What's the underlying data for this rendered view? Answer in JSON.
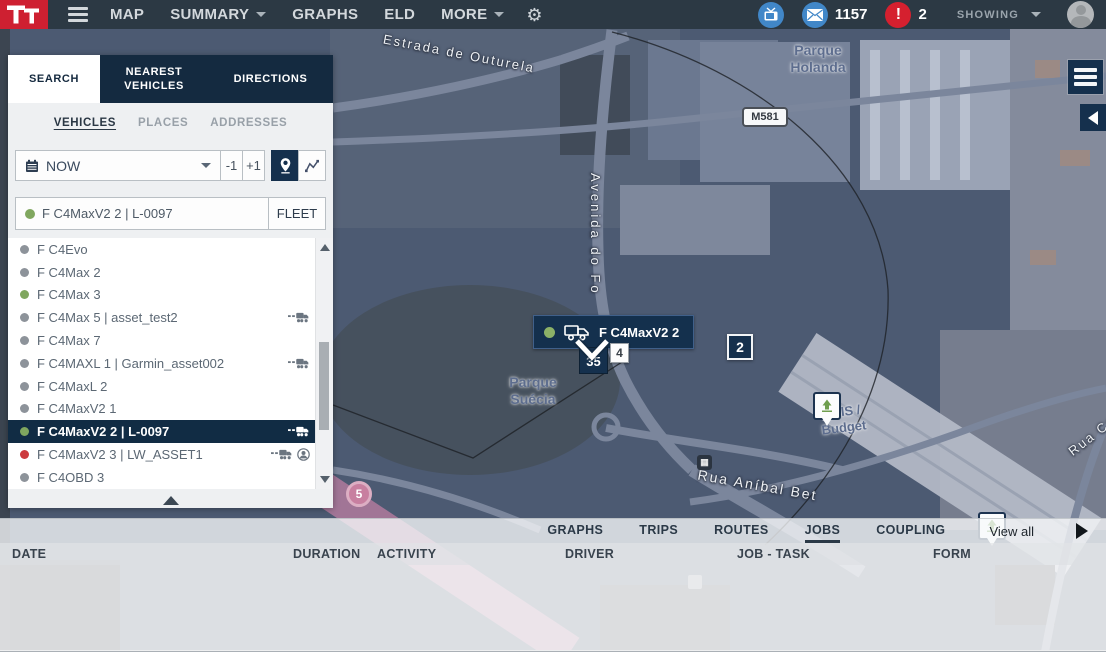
{
  "topbar": {
    "menu": [
      {
        "label": "MAP"
      },
      {
        "label": "SUMMARY",
        "caret": true
      },
      {
        "label": "GRAPHS"
      },
      {
        "label": "ELD"
      },
      {
        "label": "MORE",
        "caret": true
      }
    ],
    "messages_count": "1157",
    "alerts_count": "2",
    "showing_label": "SHOWING"
  },
  "search_panel": {
    "tabs": [
      {
        "label": "SEARCH",
        "active": true
      },
      {
        "label": "NEAREST VEHICLES"
      },
      {
        "label": "DIRECTIONS"
      }
    ],
    "subtabs": [
      {
        "label": "VEHICLES",
        "active": true
      },
      {
        "label": "PLACES"
      },
      {
        "label": "ADDRESSES"
      }
    ],
    "time_controls": {
      "selected": "NOW",
      "step_back": "-1",
      "step_forward": "+1"
    },
    "vehicle_search": {
      "value": "F C4MaxV2 2 | L-0097",
      "status": "green"
    },
    "fleet_button": "FLEET",
    "vehicles": [
      {
        "name": "F C4Evo",
        "status": "gray"
      },
      {
        "name": "F C4Max 2",
        "status": "gray"
      },
      {
        "name": "F C4Max 3",
        "status": "green"
      },
      {
        "name": "F C4Max 5 | asset_test2",
        "status": "gray",
        "truck": true
      },
      {
        "name": "F C4Max 7",
        "status": "gray"
      },
      {
        "name": "F C4MAXL 1 | Garmin_asset002",
        "status": "gray",
        "truck": true
      },
      {
        "name": "F C4MaxL 2",
        "status": "gray"
      },
      {
        "name": "F C4MaxV2 1",
        "status": "gray"
      },
      {
        "name": "F C4MaxV2 2 | L-0097",
        "status": "green",
        "truck": true,
        "selected": true
      },
      {
        "name": "F C4MaxV2 3 | LW_ASSET1",
        "status": "red",
        "truck": true,
        "driver": true
      },
      {
        "name": "F C4OBD 3",
        "status": "gray"
      }
    ]
  },
  "map": {
    "labels": {
      "road_top": "Estrada de Outurela",
      "park_ne_line1": "Parque",
      "park_ne_line2": "Holanda",
      "road_shield": "M581",
      "avenue": "Avenida do Fo",
      "park_sw_line1": "Parque",
      "park_sw_line2": "Suécia",
      "poi_line1": "AVIS /",
      "poi_line2": "Budget",
      "road_bottom": "Rua Aníbal Bet",
      "road_right": "Rua Ca",
      "highway_badge": "5"
    },
    "markers": {
      "selected_vehicle_label": "F C4MaxV2 2",
      "speed": "35",
      "place_number": "4",
      "cluster_count": "2"
    }
  },
  "bottom_panel": {
    "tabs": [
      {
        "label": "GRAPHS"
      },
      {
        "label": "TRIPS"
      },
      {
        "label": "ROUTES"
      },
      {
        "label": "JOBS",
        "active": true
      },
      {
        "label": "COUPLING"
      }
    ],
    "view_all_label": "View all",
    "columns": [
      {
        "label": "DATE"
      },
      {
        "label": "DURATION"
      },
      {
        "label": "ACTIVITY"
      },
      {
        "label": "DRIVER"
      },
      {
        "label": "JOB - TASK"
      },
      {
        "label": "FORM"
      }
    ]
  },
  "colors": {
    "brand_red": "#ce2031",
    "navy": "#14304d",
    "topbar_bg": "#2c3944",
    "accent_blue": "#4187c8",
    "alert_red": "#d5202f",
    "status_green": "#80a75f",
    "status_red": "#cc3b3e",
    "status_gray": "#8d939a"
  }
}
